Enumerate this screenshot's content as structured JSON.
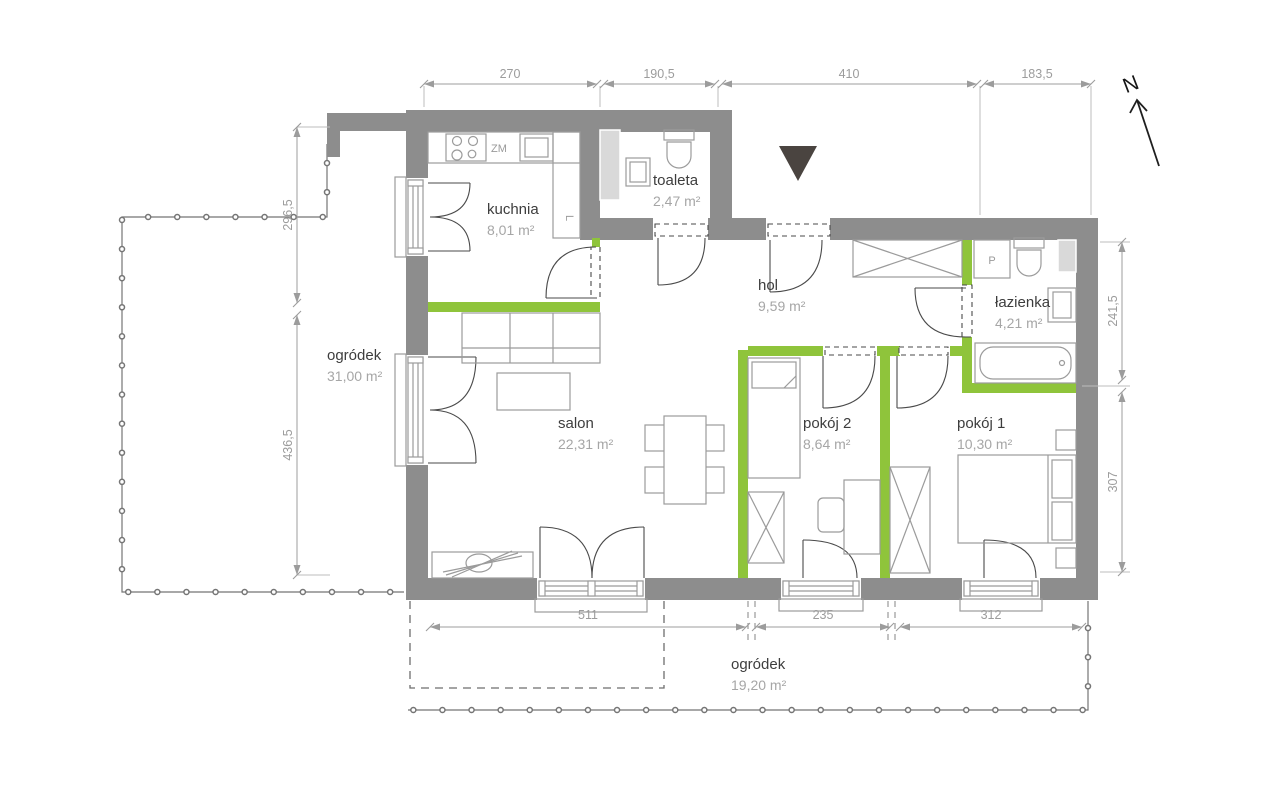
{
  "plan": {
    "north_label": "N",
    "colors": {
      "wall": "#8d8d8d",
      "partition": "#8fc43b",
      "shaft": "#d9d9d9",
      "furn": "#9b9b9b",
      "dim": "#9c9c9c",
      "text_dark": "#3d3d3d",
      "text_gray": "#a6a6a6",
      "entrance": "#4a4440"
    },
    "rooms": [
      {
        "name": "kuchnia",
        "area": "8,01 m²"
      },
      {
        "name": "toaleta",
        "area": "2,47 m²"
      },
      {
        "name": "hol",
        "area": "9,59 m²"
      },
      {
        "name": "łazienka",
        "area": "4,21 m²"
      },
      {
        "name": "salon",
        "area": "22,31 m²"
      },
      {
        "name": "pokój 2",
        "area": "8,64 m²"
      },
      {
        "name": "pokój 1",
        "area": "10,30 m²"
      },
      {
        "name": "ogródek",
        "area": "31,00 m²"
      },
      {
        "name": "ogródek",
        "area": "19,20 m²"
      }
    ],
    "dimensions": {
      "top": [
        "270",
        "190,5",
        "410",
        "183,5"
      ],
      "left": [
        "296,5",
        "436,5"
      ],
      "right": [
        "241,5",
        "307"
      ],
      "bottom": [
        "511",
        "235",
        "312"
      ]
    },
    "fixtures": {
      "washer": "P",
      "fridge": "L",
      "sink_unit": "ZM"
    }
  }
}
